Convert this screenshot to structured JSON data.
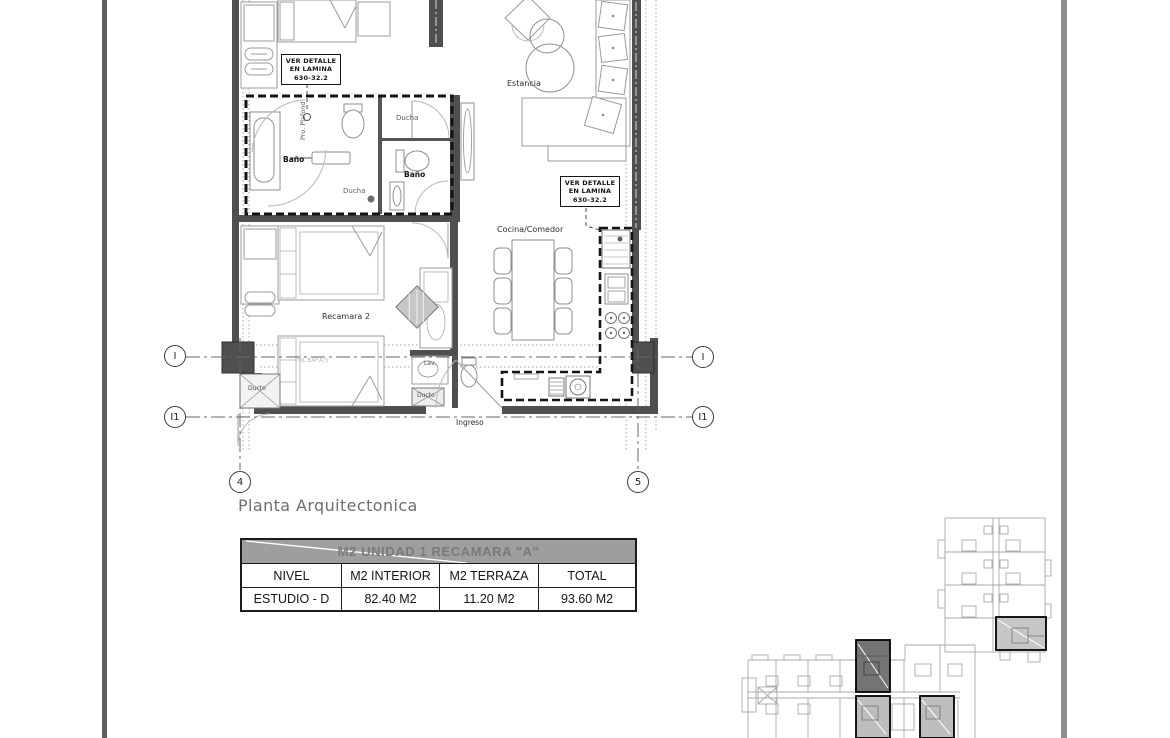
{
  "plan": {
    "title": "Planta Arquitectonica",
    "detail_note": {
      "line1": "VER DETALLE",
      "line2": "EN LAMINA",
      "line3": "630-32.2"
    },
    "rooms": {
      "bano_main": "Baño",
      "ducha_main": "Ducha",
      "ducha_2": "Ducha",
      "bano_2": "Baño",
      "estancia": "Estancia",
      "cocina_comedor": "Cocina/Comedor",
      "recamara_2": "Recamara  2",
      "ingreso": "Ingreso",
      "ducto": "Ducto",
      "lav": "Lav.",
      "ducto_2": "Ducto",
      "pro_plafond": "Pro. Plafond"
    },
    "annotations": {
      "centerline_note": "POL.BAF.A/3"
    },
    "grid_markers": {
      "row_top": "I",
      "row_bottom": "I1",
      "col_left": "4",
      "col_right": "5"
    }
  },
  "area_table": {
    "title": "M2 UNIDAD  1 RECAMARA \"A\"",
    "columns": [
      "NIVEL",
      "M2 INTERIOR",
      "M2 TERRAZA",
      "TOTAL"
    ],
    "row": {
      "nivel": "ESTUDIO - D",
      "interior": "82.40 M2",
      "terraza": "11.20 M2",
      "total": "93.60 M2"
    }
  },
  "colors": {
    "wall": "#4f4f4f",
    "heavy_outline": "#141414",
    "furniture_line": "#9b9b9b",
    "grid_line": "#666666",
    "table_header_bg": "#9e9e9e",
    "table_header_text": "#7a7a7a",
    "keyplan_line": "#a8a8a8",
    "highlight_dark": "#747474",
    "highlight_light": "#bdbdbd",
    "sheet_bar_left": "#5f5f5f",
    "sheet_bar_right": "#8d8d8d"
  }
}
